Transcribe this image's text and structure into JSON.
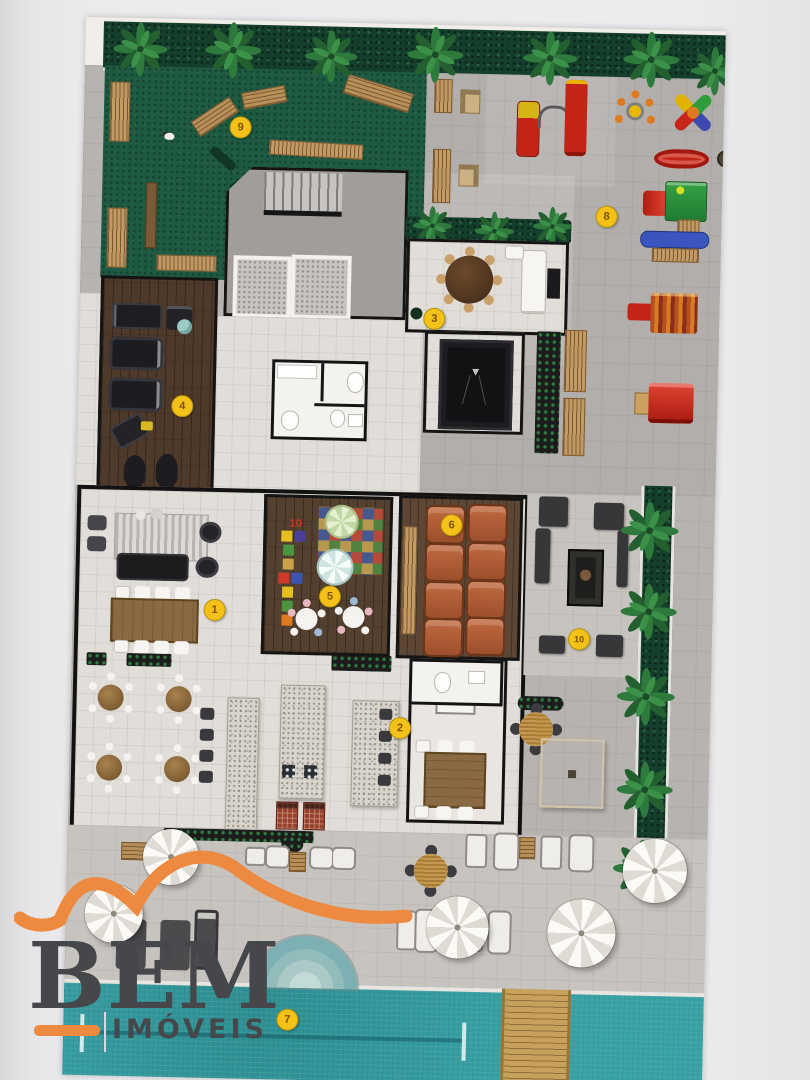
{
  "plan_markers": {
    "fill": "#f3c118",
    "border": "#b8940a",
    "text_color": "#7d5200",
    "items": [
      {
        "n": "1",
        "x": 141,
        "y": 589
      },
      {
        "n": "2",
        "x": 329,
        "y": 703
      },
      {
        "n": "3",
        "x": 354,
        "y": 293
      },
      {
        "n": "4",
        "x": 104,
        "y": 386
      },
      {
        "n": "5",
        "x": 256,
        "y": 573
      },
      {
        "n": "6",
        "x": 376,
        "y": 499
      },
      {
        "n": "7",
        "x": 223,
        "y": 997
      },
      {
        "n": "8",
        "x": 524,
        "y": 187
      },
      {
        "n": "9",
        "x": 156,
        "y": 106
      },
      {
        "n": "10",
        "x": 506,
        "y": 610
      }
    ]
  },
  "kids_room": {
    "hopscotch_number": "10",
    "hopscotch_color": "#d63024"
  },
  "logo": {
    "brand": "BEM",
    "subtitle": "IMÓVEIS",
    "orange": "#ee8a3f",
    "text_color": "#46474a"
  },
  "colors": {
    "grass_green": "#1d5a41",
    "hedge_green": "#153f2d",
    "pool_teal": "#39a2a5",
    "paving_gray": "#b7b3b0",
    "hall_tile": "#e1ddd8",
    "wood_floor": "#4e3a2b"
  }
}
